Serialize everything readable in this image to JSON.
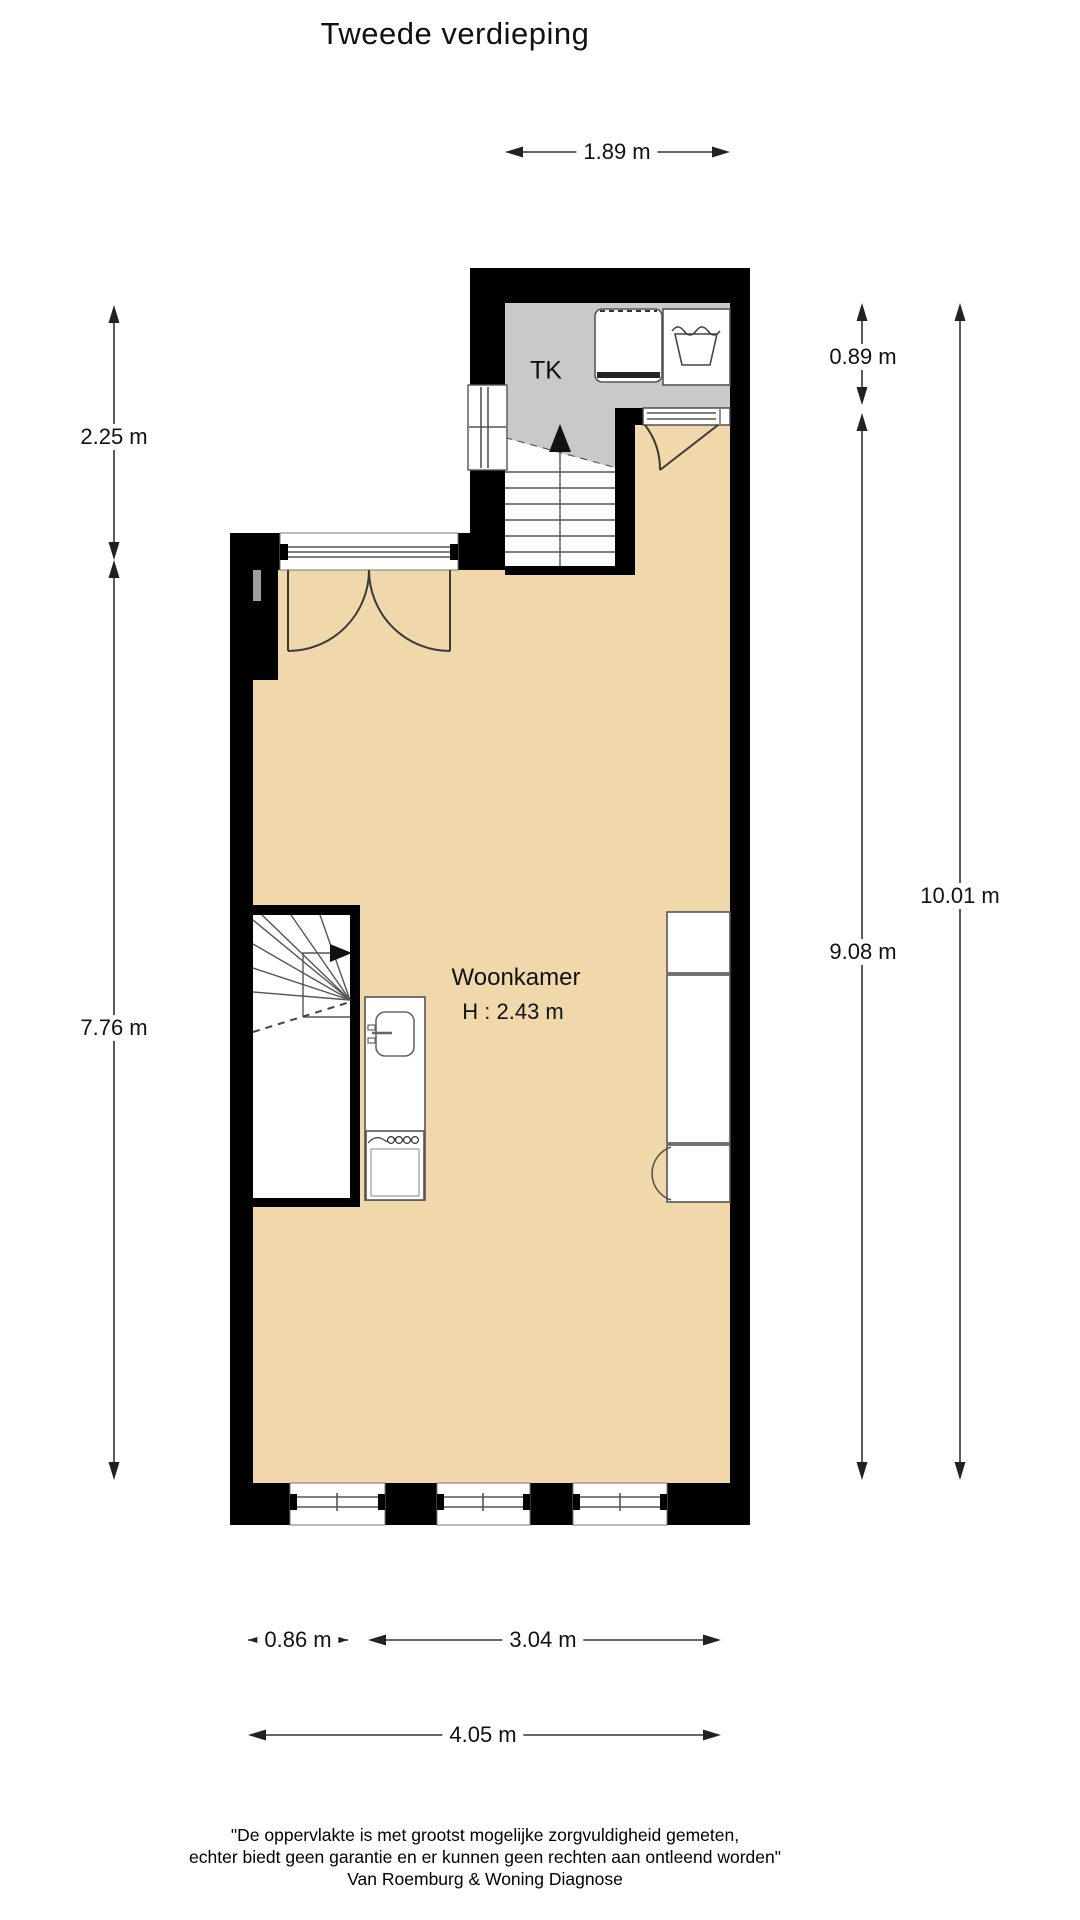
{
  "title": "Tweede verdieping",
  "plan": {
    "closet_label": "TK",
    "room_name": "Woonkamer",
    "room_height": "H : 2.43 m"
  },
  "dimensions": {
    "top_width": "1.89 m",
    "upper_left_height": "2.25 m",
    "lower_left_height": "7.76 m",
    "upper_right_height": "0.89 m",
    "inner_right_height": "9.08 m",
    "total_right_height": "10.01 m",
    "bottom_left_width": "0.86 m",
    "bottom_mid_width": "3.04 m",
    "bottom_total_width": "4.05 m"
  },
  "footer": {
    "line1": "\"De oppervlakte is met grootst mogelijke zorgvuldigheid gemeten,",
    "line2": "echter biedt geen garantie en er kunnen geen rechten aan ontleend worden\"",
    "line3": "Van Roemburg & Woning Diagnose"
  },
  "colors": {
    "floor": "#F0D8AB",
    "closet": "#C9C9C9",
    "wall": "#000000"
  }
}
